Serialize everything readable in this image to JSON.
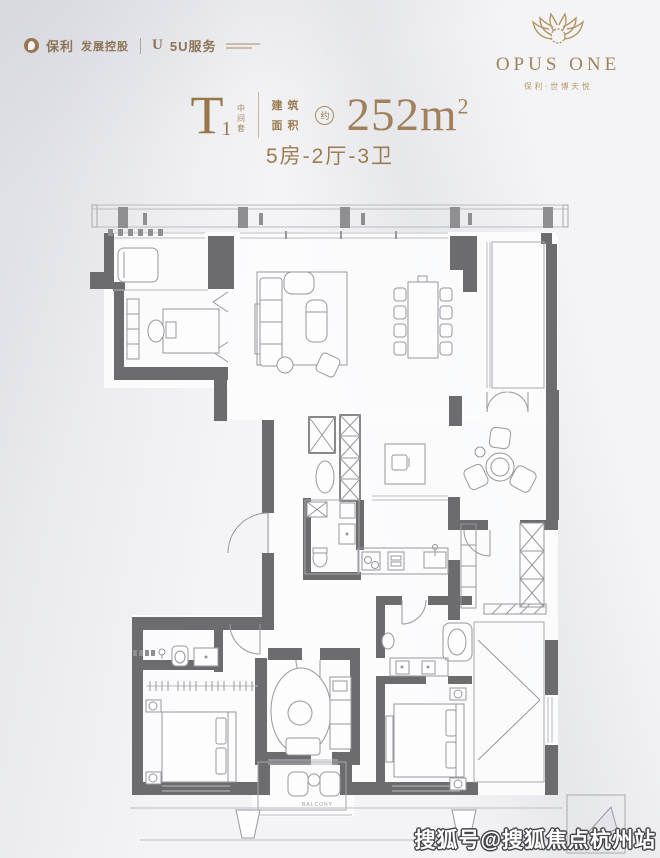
{
  "brand": {
    "poly_name": "保利",
    "poly_suffix": "发展控股",
    "service_name": "5U服务",
    "name": "OPUS ONE",
    "subtitle": "保利·世博天悦"
  },
  "title": {
    "unit_letter": "T",
    "unit_number": "1",
    "unit_tag": "中间套",
    "area_label_top": "建筑",
    "area_label_bottom": "面积",
    "approx_badge": "约",
    "area_value": "252m",
    "area_superscript": "2",
    "layout_spec": "5房-2厅-3卫"
  },
  "floorplan": {
    "balcony_label": "BALCONY"
  },
  "watermark": {
    "text": "搜狐号@搜狐焦点杭州站"
  },
  "colors": {
    "bronze": "#9c7c50",
    "gold": "#a98c5e",
    "wall": "#6c6c6f",
    "line": "#98989e",
    "watermark_outline": "#47474b"
  }
}
